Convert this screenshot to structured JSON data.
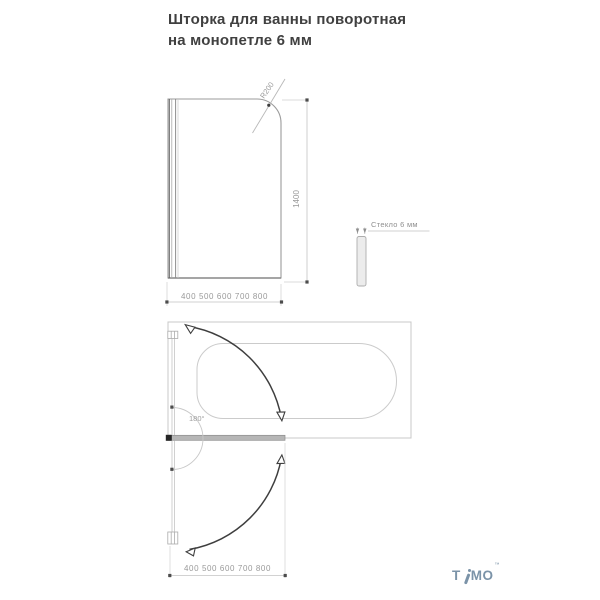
{
  "title": {
    "line1": "Шторка для ванны поворотная",
    "line2": "на монопетле 6 мм"
  },
  "front_view": {
    "radius_label": "R200",
    "height_label": "1400",
    "width_label": "400 500 600 700 800"
  },
  "side_view": {
    "glass_label": "Стекло 6 мм"
  },
  "plan_view": {
    "angle_label": "180°",
    "width_label": "400 500 600 700 800"
  },
  "logo": {
    "letter_t": "T",
    "letters_mo": "MO",
    "trademark": "™"
  },
  "colors": {
    "title_text": "#404040",
    "dimension_text": "#999999",
    "thin_line": "#c6c6c6",
    "glass_outline": "#9b9b9b",
    "swing_arc": "#3e3e3e",
    "screen_bar_fill": "#b6b6b6",
    "logo_blue": "#7b93a8"
  }
}
